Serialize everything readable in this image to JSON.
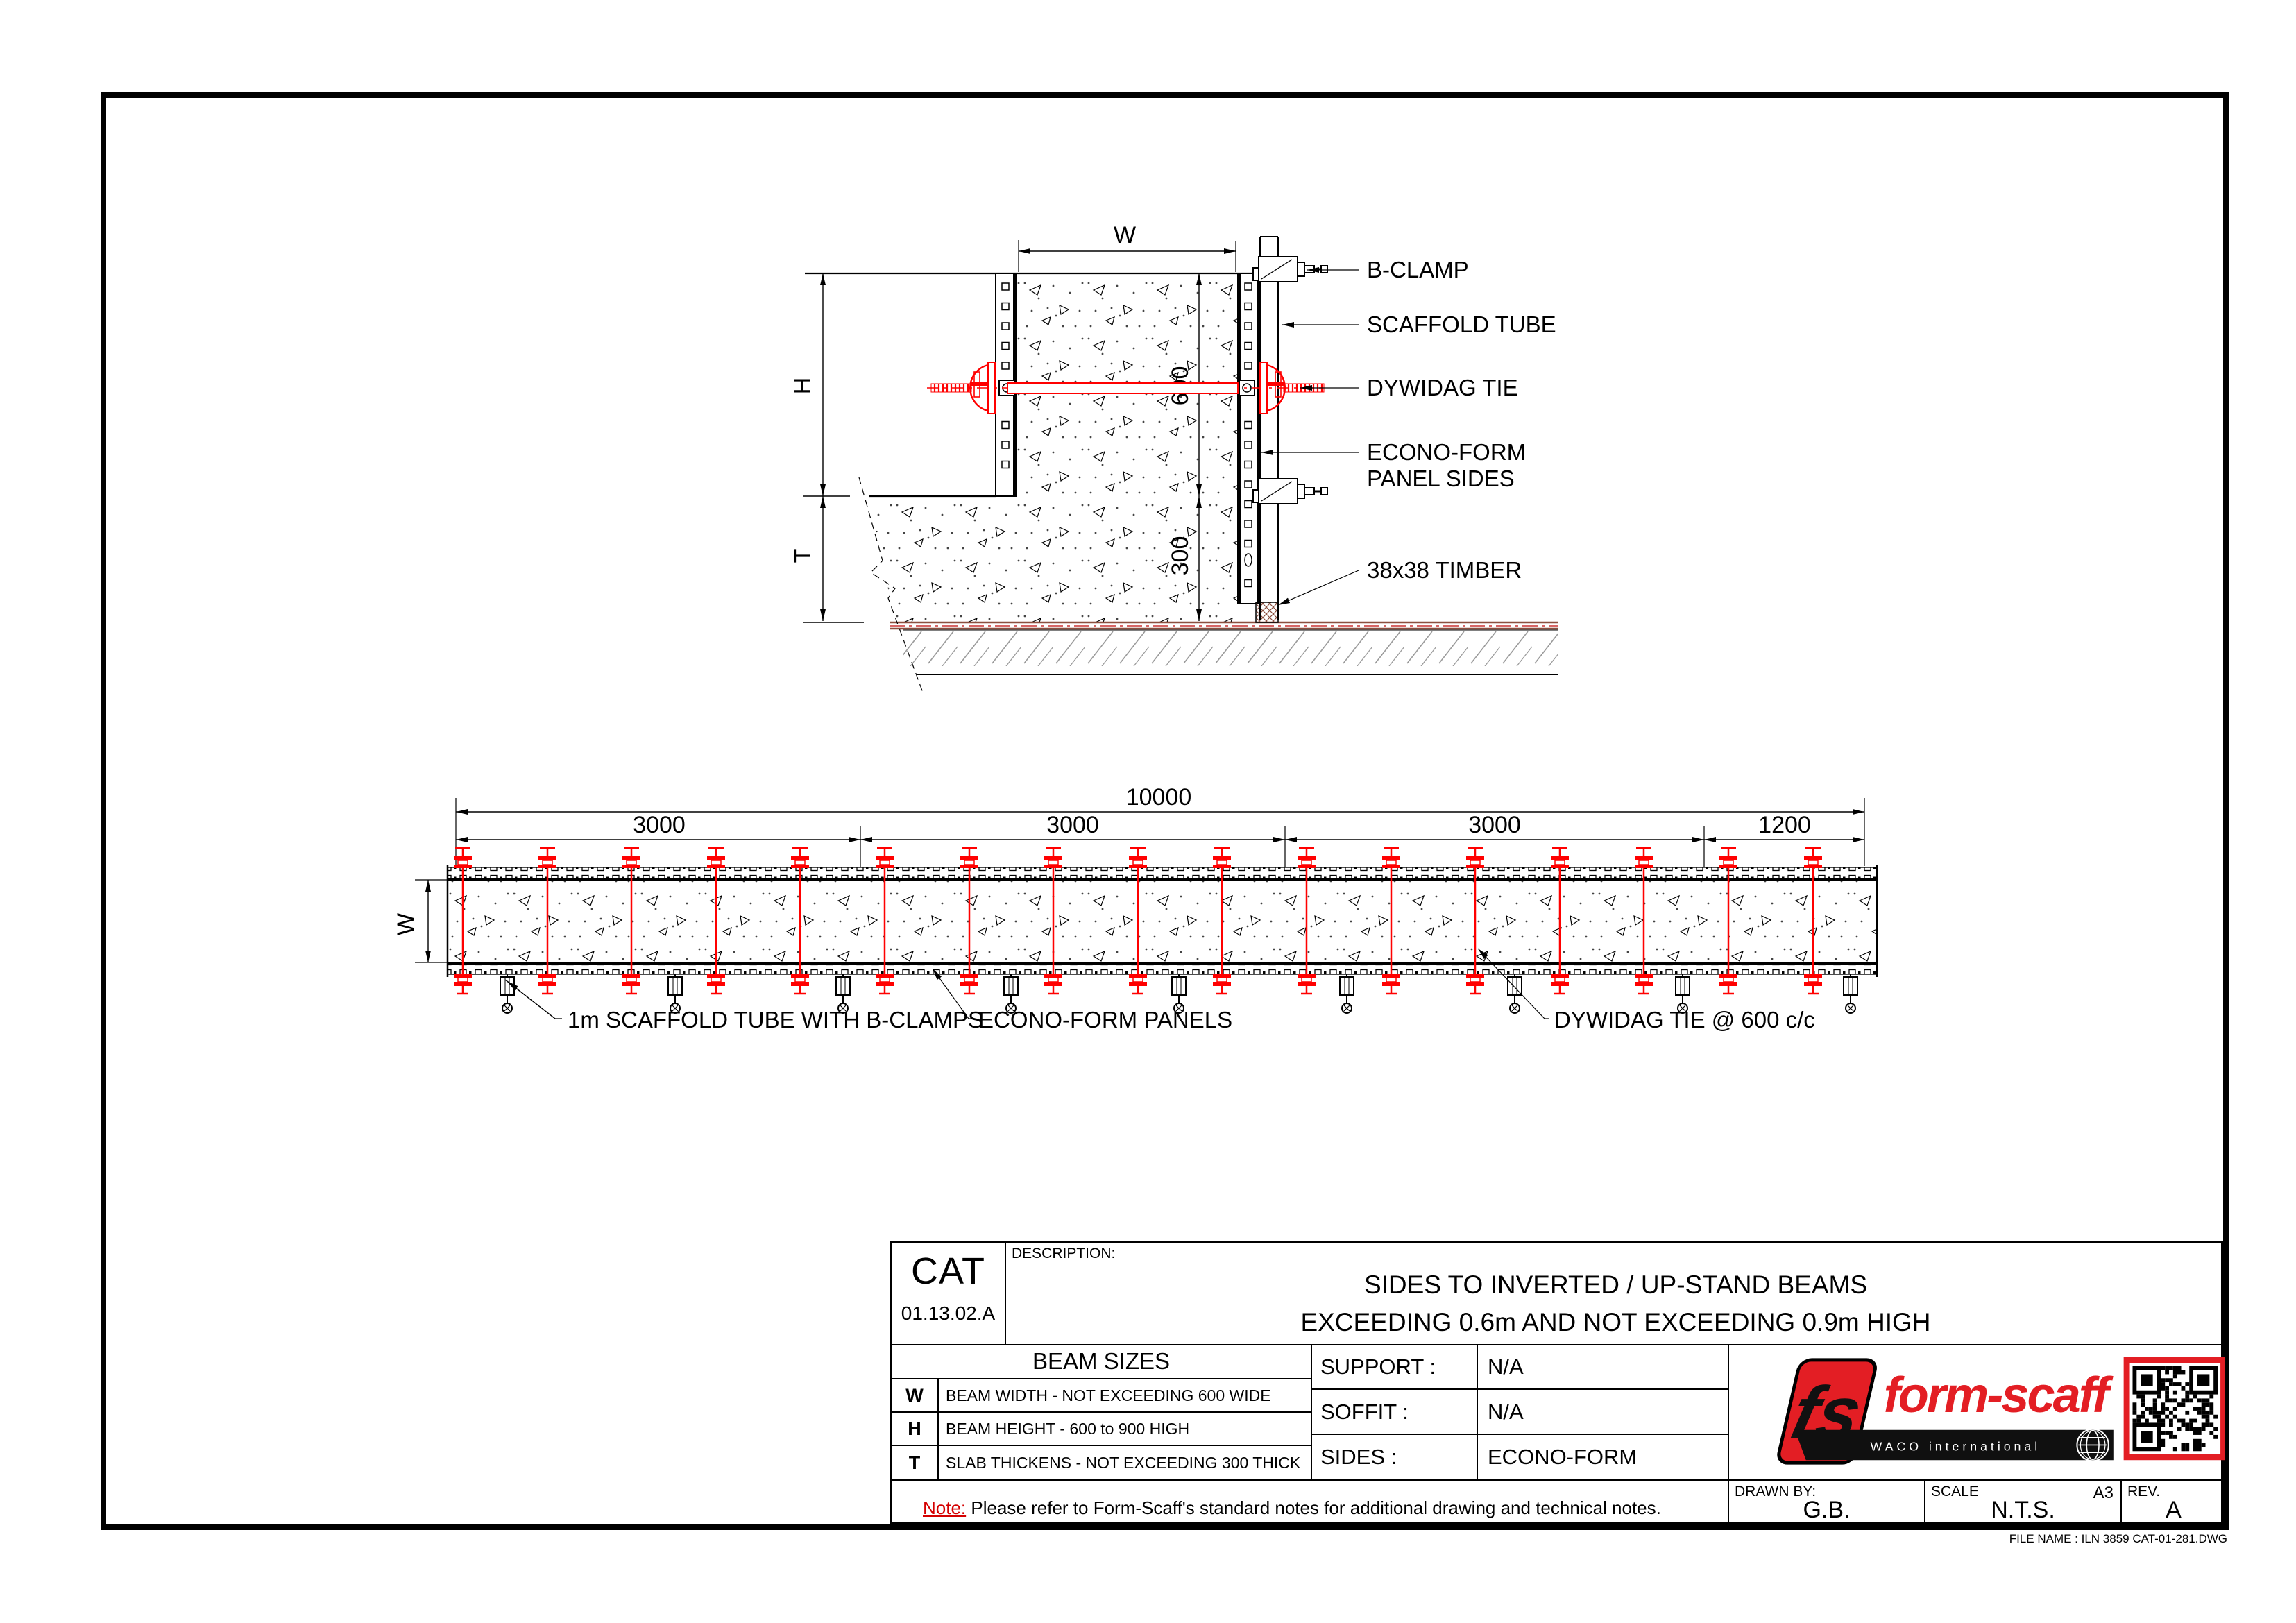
{
  "section": {
    "labels": {
      "b_clamp": "B-CLAMP",
      "scaffold_tube": "SCAFFOLD TUBE",
      "dywidag_tie": "DYWIDAG TIE",
      "econo_form_line1": "ECONO-FORM",
      "econo_form_line2": "PANEL SIDES",
      "timber": "38x38 TIMBER"
    },
    "dims": {
      "w": "W",
      "h": "H",
      "t": "T",
      "d600": "600",
      "d300": "300"
    }
  },
  "plan": {
    "labels": {
      "scaffold": "1m SCAFFOLD TUBE WITH B-CLAMPS",
      "panels": "ECONO-FORM PANELS",
      "tie": "DYWIDAG TIE @ 600 c/c"
    },
    "dims": {
      "total": "10000",
      "segs": [
        "3000",
        "3000",
        "3000",
        "1200"
      ],
      "w": "W"
    }
  },
  "title_block": {
    "cat": "CAT",
    "cat_no": "01.13.02.A",
    "description_label": "DESCRIPTION:",
    "description_line1": "SIDES TO INVERTED / UP-STAND BEAMS",
    "description_line2": "EXCEEDING 0.6m AND NOT EXCEEDING 0.9m HIGH",
    "beam_sizes_title": "BEAM SIZES",
    "rows": [
      {
        "key": "W",
        "desc": "BEAM WIDTH - NOT EXCEEDING 600 WIDE"
      },
      {
        "key": "H",
        "desc": "BEAM HEIGHT - 600 to 900 HIGH"
      },
      {
        "key": "T",
        "desc": "SLAB THICKENS - NOT EXCEEDING 300 THICK"
      }
    ],
    "support_label": "SUPPORT :",
    "support_value": "N/A",
    "soffit_label": "SOFFIT :",
    "soffit_value": "N/A",
    "sides_label": "SIDES :",
    "sides_value": "ECONO-FORM",
    "note_label": "Note:",
    "note_text": " Please refer to Form-Scaff's standard notes for additional drawing and technical notes.",
    "drawn_by_label": "DRAWN BY:",
    "drawn_by_value": "G.B.",
    "scale_label": "SCALE",
    "scale_value": "N.T.S.",
    "paper": "A3",
    "rev_label": "REV.",
    "rev_value": "A",
    "file_name": "FILE NAME : ILN 3859 CAT-01-281.DWG",
    "logo": {
      "monogram": "fs",
      "brand": "form-scaff",
      "sub": "WACO international"
    }
  },
  "colors": {
    "cad_red": "#ff0000",
    "brand_red": "#e31e24",
    "brown": "#8b4f3f"
  }
}
